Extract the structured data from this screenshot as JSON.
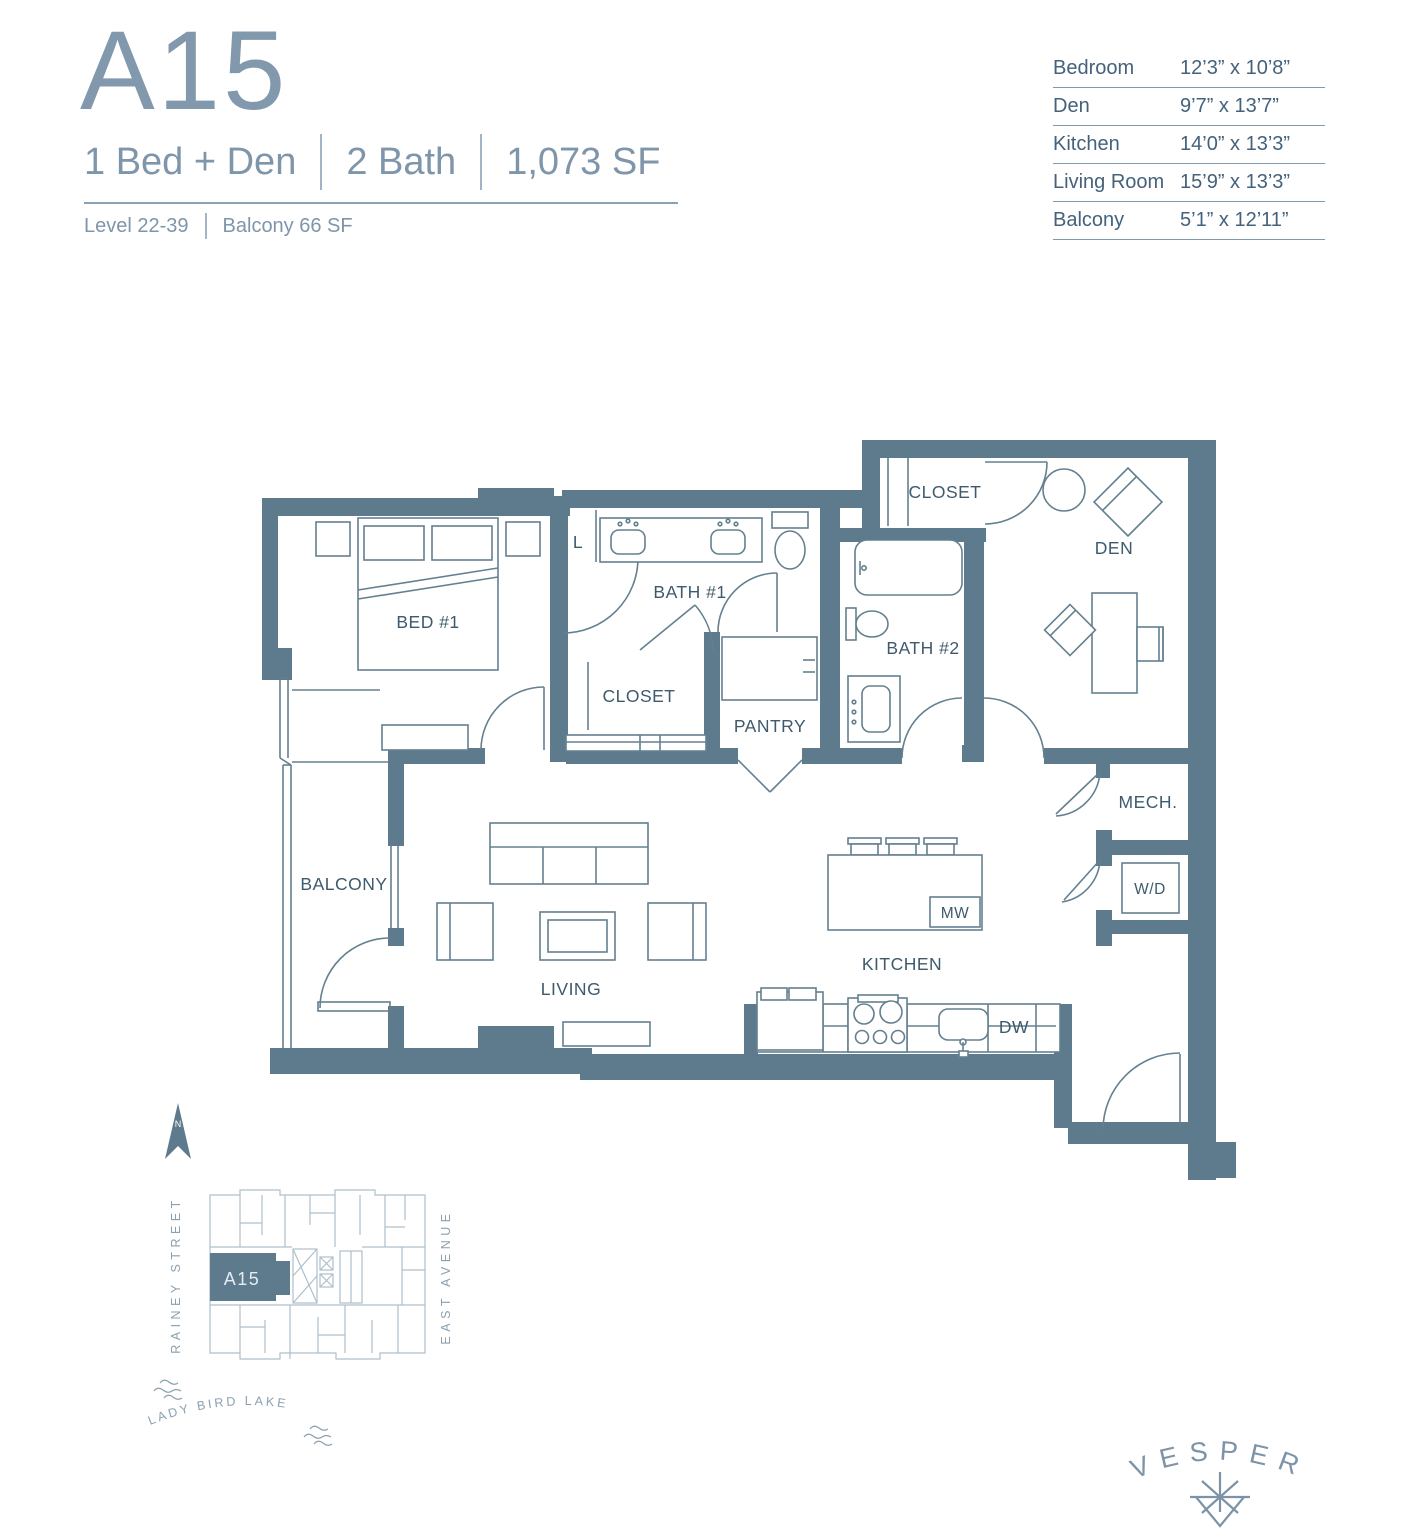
{
  "header": {
    "unit": "A15",
    "specs": [
      "1 Bed + Den",
      "2 Bath",
      "1,073 SF"
    ],
    "meta": [
      "Level 22-39",
      "Balcony 66 SF"
    ]
  },
  "dim_table": {
    "rows": [
      {
        "room": "Bedroom",
        "size": "12’3” x 10’8”"
      },
      {
        "room": "Den",
        "size": "9’7” x 13’7”"
      },
      {
        "room": "Kitchen",
        "size": "14’0” x 13’3”"
      },
      {
        "room": "Living Room",
        "size": "15’9” x 13’3”"
      },
      {
        "room": "Balcony",
        "size": "5’1” x 12’11”"
      }
    ]
  },
  "plan": {
    "labels": {
      "bed1": "BED #1",
      "linen": "L",
      "bath1": "BATH #1",
      "closet1": "CLOSET",
      "pantry": "PANTRY",
      "bath2": "BATH #2",
      "closet2": "CLOSET",
      "den": "DEN",
      "mech": "MECH.",
      "wd": "W/D",
      "mw": "MW",
      "dw": "DW",
      "kitchen": "KITCHEN",
      "living": "LIVING",
      "balcony": "BALCONY"
    },
    "colors": {
      "wall": "#5e7b8d",
      "line": "#64808f",
      "label": "#3e5a6c"
    }
  },
  "keyplan": {
    "north": "N",
    "unit": "A15",
    "street_left": "RAINEY STREET",
    "street_right": "EAST AVENUE",
    "lake": "LADY BIRD LAKE"
  },
  "brand": {
    "name": "VESPER"
  }
}
